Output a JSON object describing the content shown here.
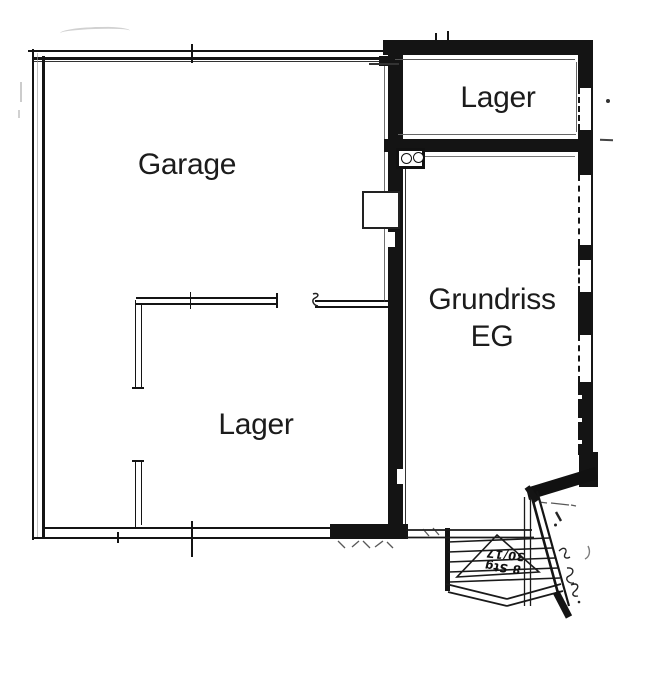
{
  "plan": {
    "rooms": {
      "garage": "Garage",
      "storage_top": "Lager",
      "storage_bottom": "Lager",
      "floorplan_title_line1": "Grundriss",
      "floorplan_title_line2": "EG"
    },
    "stairs_annotation": {
      "line1": "8 Stg",
      "line2": "30/17"
    }
  }
}
